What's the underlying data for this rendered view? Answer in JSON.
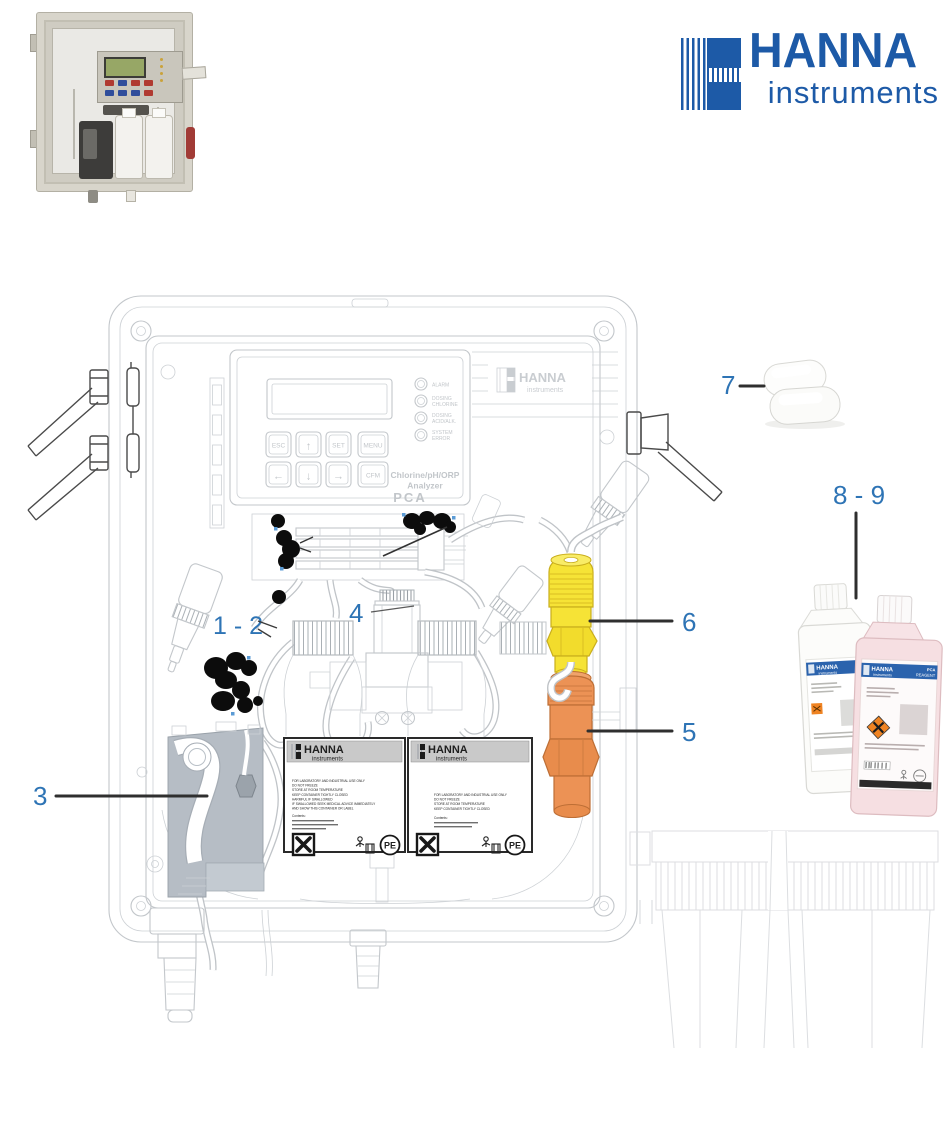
{
  "logo": {
    "word": "HANNA",
    "sub": "instruments",
    "blue": "#1d5aa7"
  },
  "callouts": {
    "c12": "1 - 2",
    "c3": "3",
    "c4": "4",
    "c5": "5",
    "c6": "6",
    "c7": "7",
    "c89": "8 - 9",
    "color": "#2E74B5"
  },
  "diagram": {
    "logo_word": "HANNA",
    "logo_sub": "instruments",
    "panel": {
      "buttons": [
        "ESC",
        "↑",
        "SET",
        "MENU",
        "←",
        "↓",
        "→",
        "CFM"
      ],
      "leds": [
        {
          "l1": "ALARM",
          "l2": ""
        },
        {
          "l1": "DOSING",
          "l2": "CHLORINE"
        },
        {
          "l1": "DOSING",
          "l2": "ACID/ALK."
        },
        {
          "l1": "SYSTEM",
          "l2": "ERROR"
        }
      ],
      "product1": "Chlorine/pH/ORP",
      "product2": "Analyzer",
      "model": "PCA"
    },
    "inner_labels": {
      "header_word": "HANNA",
      "header_sub": "instruments",
      "left_lines": [
        "FOR LABORATORY AND INDUSTRIAL USE ONLY",
        "DO NOT FREEZE",
        "STORE AT ROOM TEMPERATURE",
        "KEEP CONTAINER TIGHTLY CLOSED",
        "HARMFUL IF SWALLOWED",
        "IF SWALLOWED SEEK MEDICAL ADVICE IMMEDIATELY",
        "AND SHOW THIS CONTAINER OR LABEL",
        "Contents:"
      ],
      "right_lines": [
        "FOR LABORATORY AND INDUSTRIAL USE ONLY",
        "DO NOT FREEZE",
        "STORE AT ROOM TEMPERATURE",
        "KEEP CONTAINER TIGHTLY CLOSED",
        "Contents:"
      ],
      "pe": "PE"
    }
  },
  "reagents": {
    "word": "HANNA",
    "sub": "instruments",
    "pink_right1": "PCA",
    "pink_right2": "REAGENT"
  }
}
